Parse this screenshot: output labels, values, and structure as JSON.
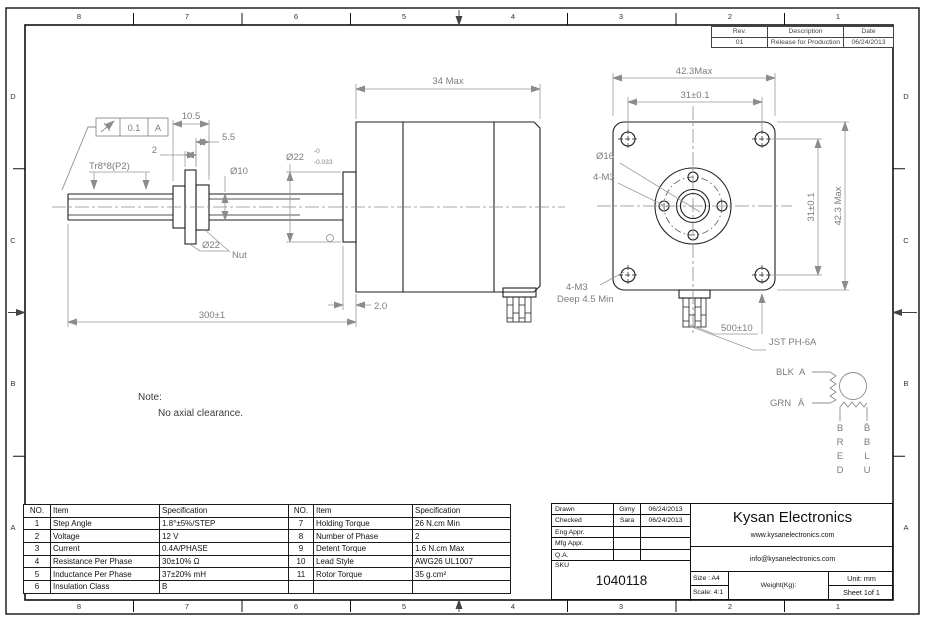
{
  "sheet": {
    "zones": {
      "cols": [
        "8",
        "7",
        "6",
        "5",
        "4",
        "3",
        "2",
        "1"
      ],
      "rows": [
        "D",
        "C",
        "B",
        "A"
      ]
    },
    "rev_table": {
      "headers": [
        "Rev.",
        "Description",
        "Date"
      ],
      "rows": [
        [
          "01",
          "Release for Production",
          "06/24/2013"
        ]
      ]
    }
  },
  "drawing": {
    "tolerance_frame": {
      "value": "0.1",
      "datum": "A"
    },
    "dims": {
      "nut_len": "10.5",
      "nut_step": "5.5",
      "flange_w": "2",
      "thread": "Tr8*8(P2)",
      "shaft_dia": "Ø10",
      "flange_dia": "Ø22",
      "nut_label": "Nut",
      "pilot_main": "Ø22",
      "pilot_upper": "-0",
      "pilot_lower": "-0.033",
      "motor_len": "34 Max",
      "pilot_w": "2.0",
      "screw_len": "300±1",
      "face_w": "42.3Max",
      "hole_cc_h": "31±0.1",
      "hole_cc_v": "31±0.1",
      "face_h": "42.3 Max",
      "boss_dia": "Ø16",
      "front_holes": "4-M3",
      "rear_holes": "4-M3",
      "rear_depth": "Deep 4.5 Min",
      "lead_len": "500±10",
      "connector": "JST PH-6A"
    },
    "note": {
      "label": "Note:",
      "text": "No axial clearance."
    },
    "wiring": {
      "blk": "BLK",
      "grn": "GRN",
      "a": "A",
      "a_bar": "Ā",
      "left_col": [
        "B",
        "R",
        "E",
        "D"
      ],
      "right_col": [
        "B̄",
        "B",
        "L",
        "U"
      ]
    }
  },
  "spec_table_left": {
    "headers": [
      "NO.",
      "Item",
      "Specification"
    ],
    "rows": [
      [
        "1",
        "Step Angle",
        "1.8°±5%/STEP"
      ],
      [
        "2",
        "Voltage",
        "12 V"
      ],
      [
        "3",
        "Current",
        "0.4A/PHASE"
      ],
      [
        "4",
        "Resistance Per Phase",
        "30±10% Ω"
      ],
      [
        "5",
        "Inductance Per Phase",
        "37±20% mH"
      ],
      [
        "6",
        "Insulation Class",
        "B"
      ]
    ]
  },
  "spec_table_right": {
    "headers": [
      "NO.",
      "Item",
      "Specification"
    ],
    "rows": [
      [
        "7",
        "Holding Torque",
        "26 N.cm Min"
      ],
      [
        "8",
        "Number of Phase",
        "2"
      ],
      [
        "9",
        "Detent Torque",
        "1.6  N.cm Max"
      ],
      [
        "10",
        "Lead Style",
        "AWG26 UL1007"
      ],
      [
        "11",
        "Rotor Torque",
        "35 g.cm²"
      ],
      [
        "",
        "",
        ""
      ]
    ]
  },
  "title_block": {
    "rows": [
      {
        "label": "Drawn",
        "name": "Gimy",
        "date": "06/24/2013"
      },
      {
        "label": "Checked",
        "name": "Sara",
        "date": "06/24/2013"
      },
      {
        "label": "Eng Appr.",
        "name": "",
        "date": ""
      },
      {
        "label": "Mfg Appr.",
        "name": "",
        "date": ""
      },
      {
        "label": "Q.A.",
        "name": "",
        "date": ""
      }
    ],
    "sku_label": "SKU",
    "sku": "1040118",
    "company": "Kysan Electronics",
    "website": "www.kysanelectronics.com",
    "email": "info@kysanelectronics.com",
    "size": "Size : A4",
    "scale": "Scale: 4:1",
    "weight": "Weight(Kg):",
    "unit": "Unit: mm",
    "sheet": "Sheet 1of 1"
  }
}
